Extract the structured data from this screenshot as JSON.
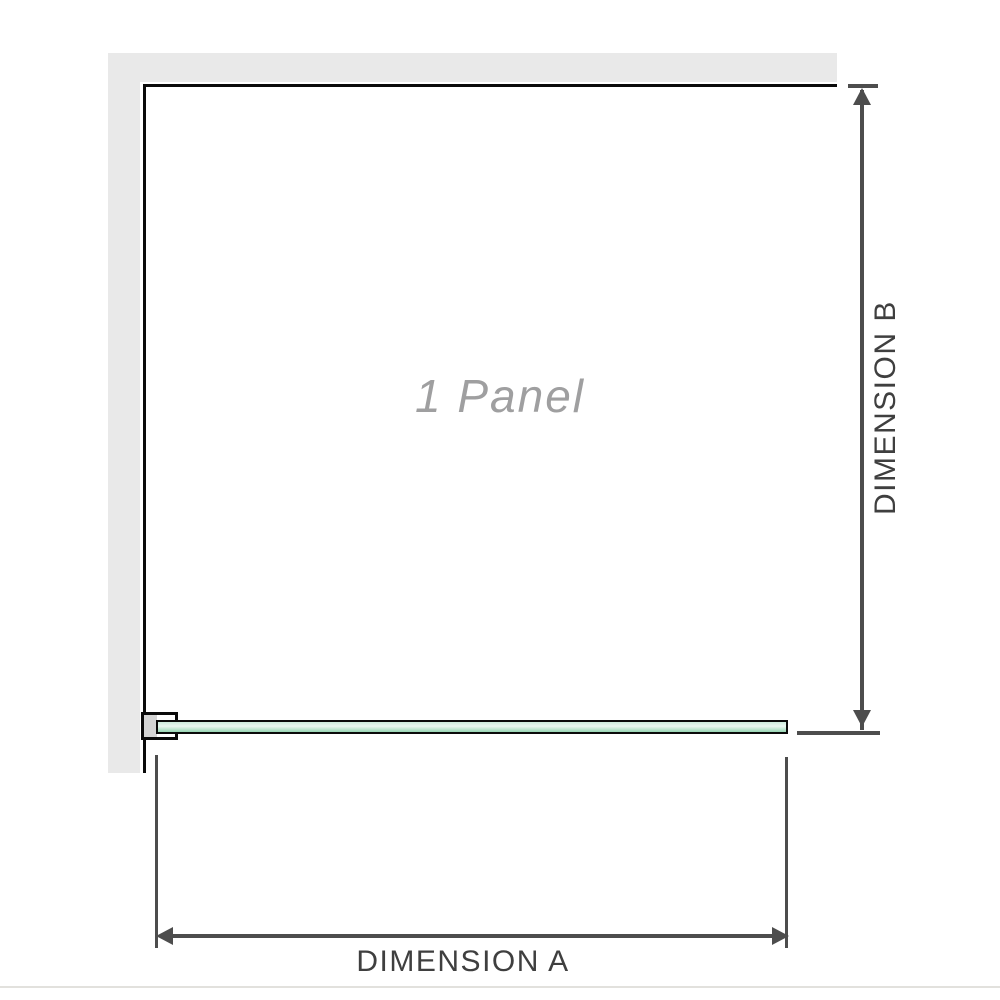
{
  "diagram": {
    "title": "1 Panel",
    "dimension_a_label": "DIMENSION A",
    "dimension_b_label": "DIMENSION B"
  },
  "colors": {
    "background": "#ffffff",
    "wall": "#e9e9e9",
    "outline": "#0a0a0a",
    "dimension": "#4d4d4d",
    "glass_top": "#cdebdc",
    "glass_mid": "#eaf7f0",
    "glass_bottom": "#97d5b3",
    "bracket_fill": "#d4d4d4",
    "panel_text": "#9f9fa0",
    "label_text": "#3f3f3f",
    "bottom_rule": "#e2e1dd"
  }
}
